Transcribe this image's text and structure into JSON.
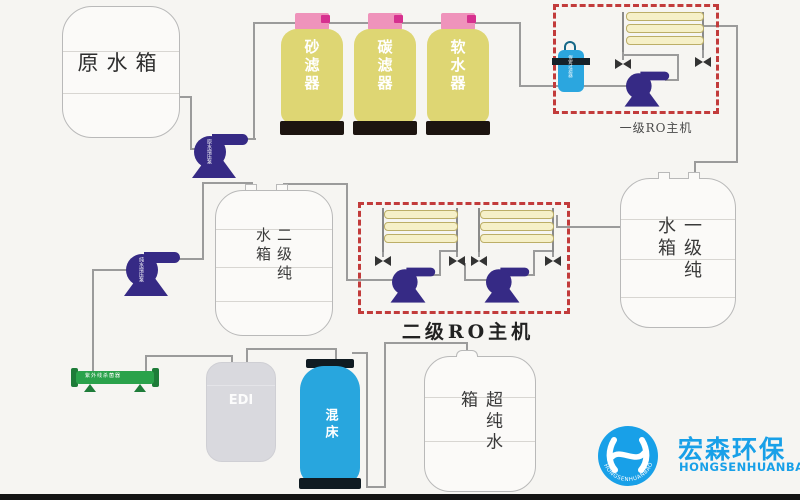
{
  "tanks": {
    "raw": {
      "label": "原水箱"
    },
    "pure_stage1": {
      "label": "一级纯水箱"
    },
    "pure_stage2": {
      "label": "二级纯水箱"
    },
    "ultra_pure": {
      "label": "超纯水箱"
    },
    "edi": {
      "label": "EDI"
    },
    "mixed_bed": {
      "label": "混床"
    }
  },
  "filters": [
    {
      "label": "砂滤器"
    },
    {
      "label": "碳滤器"
    },
    {
      "label": "软水器"
    }
  ],
  "ro_units": {
    "stage1_label": "一级RO主机",
    "stage2_label": "二级RO主机"
  },
  "small_labels": {
    "raw_pump": "原水增压泵",
    "pure_pump": "纯水增压泵",
    "security_filter": "保安过滤器",
    "uv_sterilizer": "紫外线杀菌器"
  },
  "logo": {
    "cn": "宏森环保",
    "en": "HONGSENHUANBAO",
    "ring_text": "HONGSENHUANBAO"
  },
  "colors": {
    "vessel_yellow": "#ded673",
    "cap_pink": "#ef93bb",
    "pump_purple": "#362a85",
    "dashed_red": "#c23b3b",
    "water_blue": "#2ba6df",
    "uv_green": "#2aa24b",
    "logo_blue": "#18a0e8",
    "pipe_gray": "#9b9b9b"
  }
}
